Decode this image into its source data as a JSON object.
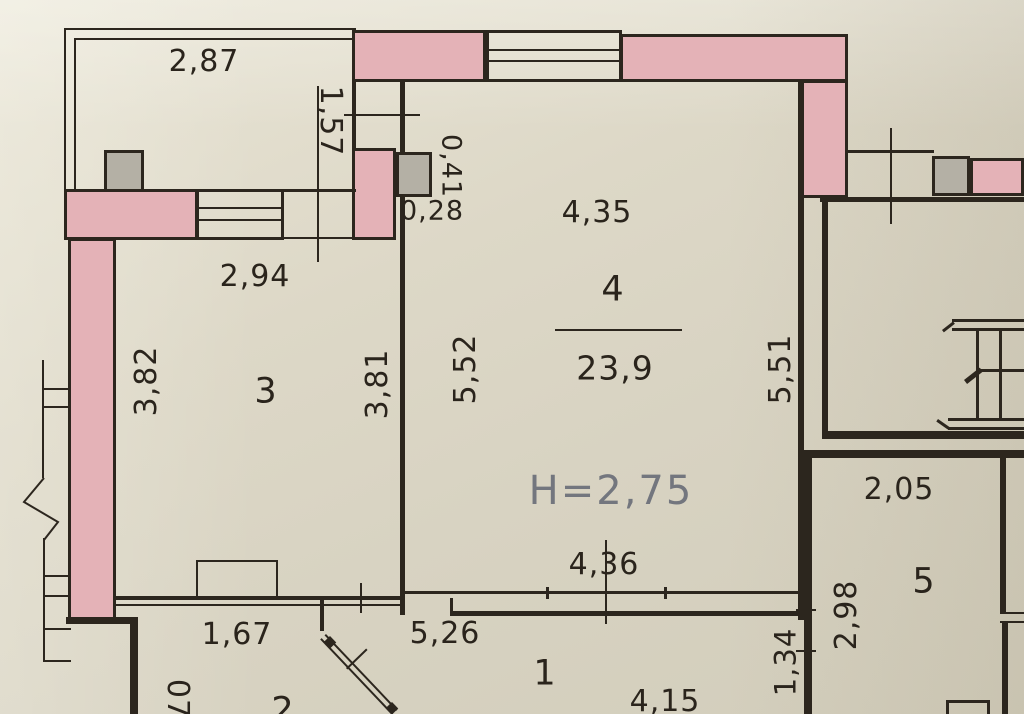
{
  "title": "apartment-floor-plan-scan",
  "colors": {
    "paper_light": "#e9e5d6",
    "paper_dark": "#d2cdbb",
    "wall": "#2c261e",
    "pink": "#e4b2b7",
    "column": "#b4b0a5",
    "dim_text": "#2a241c",
    "height_text": "#73767e"
  },
  "labels": {
    "balcony": {
      "width": "2,87"
    },
    "niche": {
      "v157": "1,57",
      "v041": "0,41",
      "v028": "0,28"
    },
    "room3": {
      "number": "3",
      "top": "2,94",
      "left": "3,82",
      "right": "3,81"
    },
    "room4": {
      "number": "4",
      "area": "23,9",
      "top": "4,35",
      "left": "5,52",
      "right": "5,51",
      "bottom": "4,36",
      "height": "H=2,75"
    },
    "room5": {
      "number": "5",
      "top": "2,05",
      "left": "2,98"
    },
    "room1": {
      "number": "1",
      "d167": "1,67",
      "d526": "5,26",
      "d415": "4,15",
      "d134": "1,34"
    },
    "room2": {
      "number": "2",
      "partial": "07"
    }
  }
}
